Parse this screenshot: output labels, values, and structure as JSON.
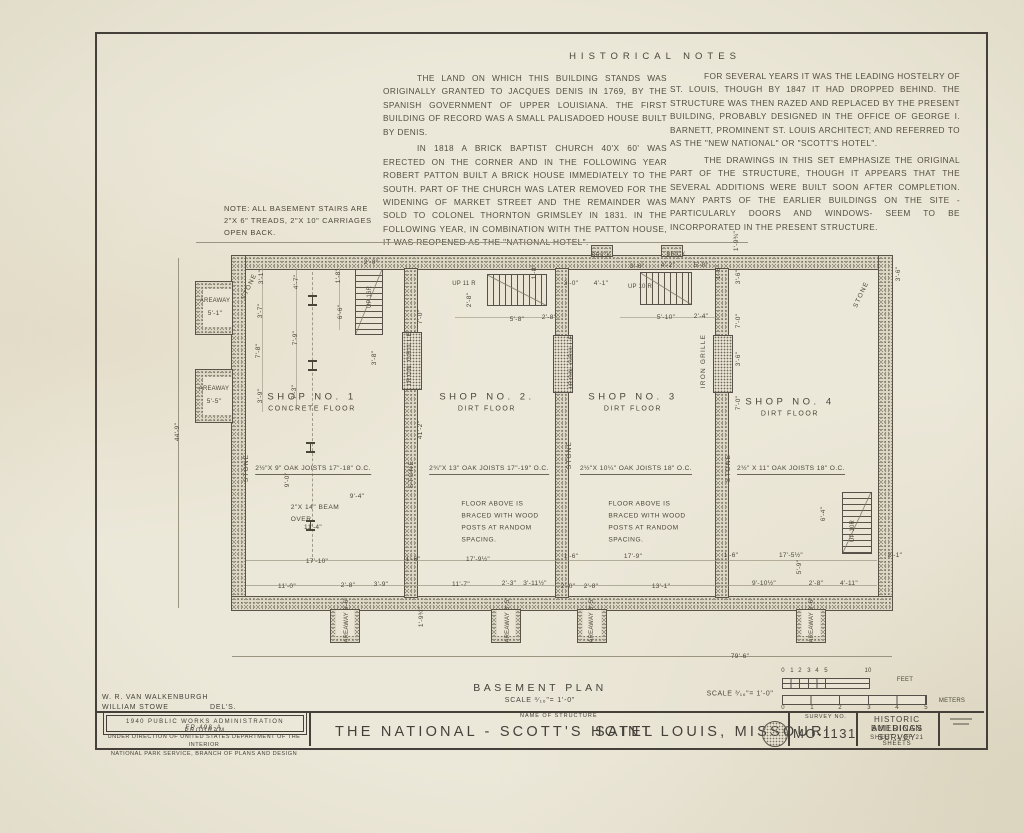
{
  "colors": {
    "paper": "#e9e4d4",
    "ink": "#46423a",
    "wall_fill": "#dcd7c4"
  },
  "notes": {
    "heading": "HISTORICAL NOTES",
    "col1": [
      "THE LAND ON WHICH THIS BUILDING STANDS WAS ORIGINALLY GRANTED TO JACQUES DENIS IN 1769, BY THE SPANISH GOVERNMENT OF UPPER LOUISIANA. THE FIRST BUILDING OF RECORD WAS A SMALL PALISADOED HOUSE BUILT BY DENIS.",
      "IN 1818 A BRICK BAPTIST CHURCH 40'X 60' WAS ERECTED ON THE CORNER AND IN THE FOLLOWING YEAR ROBERT PATTON BUILT A BRICK HOUSE IMMEDIATELY TO THE SOUTH. PART OF THE CHURCH WAS LATER REMOVED FOR THE WIDENING OF MARKET STREET AND THE REMAINDER WAS SOLD TO COLONEL THORNTON GRIMSLEY IN 1831. IN THE FOLLOWING YEAR, IN COMBINATION WITH THE PATTON HOUSE, IT WAS REOPENED AS THE \"NATIONAL HOTEL\"."
    ],
    "col2": [
      "FOR SEVERAL YEARS IT WAS THE LEADING HOSTELRY OF ST. LOUIS, THOUGH BY 1847 IT HAD DROPPED BEHIND. THE STRUCTURE WAS THEN RAZED AND REPLACED BY THE PRESENT BUILDING, PROBABLY DESIGNED IN THE OFFICE OF GEORGE I. BARNETT, PROMINENT ST. LOUIS ARCHITECT; AND REFERRED TO AS THE \"NEW NATIONAL\" OR \"SCOTT'S HOTEL\".",
      "THE DRAWINGS IN THIS SET EMPHASIZE THE ORIGINAL PART OF THE STRUCTURE, THOUGH IT APPEARS THAT THE SEVERAL ADDITIONS WERE BUILT SOON AFTER COMPLETION. MANY PARTS OF THE EARLIER BUILDINGS ON THE SITE - PARTICULARLY DOORS AND WINDOWS- SEEM TO BE INCORPORATED IN THE PRESENT STRUCTURE."
    ]
  },
  "stair_note": [
    "NOTE: ALL BASEMENT STAIRS ARE",
    "2\"X 6\" TREADS, 2\"X 10\" CARRIAGES",
    "OPEN BACK."
  ],
  "plan": {
    "shops": [
      {
        "name": "SHOP NO. 1",
        "floor": "CONCRETE FLOOR",
        "x": 312,
        "y": 402
      },
      {
        "name": "SHOP NO. 2.",
        "floor": "DIRT FLOOR",
        "x": 487,
        "y": 402
      },
      {
        "name": "SHOP NO. 3",
        "floor": "DIRT FLOOR",
        "x": 633,
        "y": 402
      },
      {
        "name": "SHOP NO. 4",
        "floor": "DIRT FLOOR",
        "x": 790,
        "y": 407
      }
    ],
    "joists": [
      {
        "t": "2½\"X 9\" OAK JOISTS 17\"-18\" O.C.",
        "x": 313,
        "y": 470
      },
      {
        "t": "2¾\"X 13\" OAK JOISTS 17\"-19\" O.C.",
        "x": 489,
        "y": 470
      },
      {
        "t": "2½\"X 10¼\" OAK JOISTS 18\" O.C.",
        "x": 636,
        "y": 470
      },
      {
        "t": "2½\" X 11\" OAK JOISTS 18\" O.C.",
        "x": 791,
        "y": 470
      }
    ],
    "floor_note": [
      "FLOOR ABOVE IS",
      "BRACED WITH WOOD",
      "POSTS AT RANDOM",
      "SPACING."
    ],
    "floor_note_pos": [
      {
        "x": 500,
        "y": 522
      },
      {
        "x": 647,
        "y": 522
      }
    ],
    "beam_note": [
      "2\"X 14\" BEAM",
      "OVER."
    ],
    "labels": [
      {
        "t": "STONE",
        "x": 250,
        "y": 287,
        "r": -65
      },
      {
        "t": "STONE",
        "x": 247,
        "y": 468,
        "r": -90
      },
      {
        "t": "STONE",
        "x": 412,
        "y": 474,
        "r": -90
      },
      {
        "t": "STONE",
        "x": 570,
        "y": 455,
        "r": -90
      },
      {
        "t": "STONE",
        "x": 729,
        "y": 468,
        "r": -90
      },
      {
        "t": "STONE",
        "x": 862,
        "y": 295,
        "r": -65
      },
      {
        "t": "IRON GRILLE",
        "x": 410,
        "y": 358,
        "r": -90
      },
      {
        "t": "IRON GRILLE",
        "x": 572,
        "y": 361,
        "r": -90
      },
      {
        "t": "IRON GRILLE",
        "x": 704,
        "y": 361,
        "r": -90
      },
      {
        "t": "BRICK",
        "x": 601,
        "y": 256,
        "cls": "tiny"
      },
      {
        "t": "BRICK",
        "x": 676,
        "y": 255,
        "cls": "tiny"
      },
      {
        "t": "AREAWAY",
        "x": 215,
        "y": 301,
        "cls": "tiny"
      },
      {
        "t": "AREAWAY",
        "x": 214,
        "y": 389,
        "cls": "tiny"
      },
      {
        "t": "AREAWAY 3'-6\"",
        "x": 347,
        "y": 620,
        "r": -90,
        "cls": "tiny"
      },
      {
        "t": "AREAWAY 3'-5\"",
        "x": 508,
        "y": 620,
        "r": -90,
        "cls": "tiny"
      },
      {
        "t": "AREAWAY 3'-5\"",
        "x": 592,
        "y": 620,
        "r": -90,
        "cls": "tiny"
      },
      {
        "t": "AREAWAY 3'-6\"",
        "x": 812,
        "y": 620,
        "r": -90,
        "cls": "tiny"
      },
      {
        "t": "UP 16R",
        "x": 370,
        "y": 297,
        "r": -90,
        "cls": "tiny"
      },
      {
        "t": "UP 11 R",
        "x": 464,
        "y": 284,
        "cls": "tiny"
      },
      {
        "t": "UP 10 R",
        "x": 640,
        "y": 287,
        "cls": "tiny"
      },
      {
        "t": "UP 10R",
        "x": 853,
        "y": 531,
        "r": -90,
        "cls": "tiny"
      },
      {
        "t": "0",
        "x": 783,
        "y": 671,
        "cls": "tiny"
      },
      {
        "t": "1",
        "x": 792,
        "y": 671,
        "cls": "tiny"
      },
      {
        "t": "2",
        "x": 800,
        "y": 671,
        "cls": "tiny"
      },
      {
        "t": "3",
        "x": 809,
        "y": 671,
        "cls": "tiny"
      },
      {
        "t": "4",
        "x": 817,
        "y": 671,
        "cls": "tiny"
      },
      {
        "t": "5",
        "x": 826,
        "y": 671,
        "cls": "tiny"
      },
      {
        "t": "10",
        "x": 868,
        "y": 671,
        "cls": "tiny"
      },
      {
        "t": "FEET",
        "x": 905,
        "y": 680,
        "cls": "tiny"
      },
      {
        "t": "0",
        "x": 783,
        "y": 708,
        "cls": "tiny"
      },
      {
        "t": "1",
        "x": 812,
        "y": 708,
        "cls": "tiny"
      },
      {
        "t": "2",
        "x": 840,
        "y": 708,
        "cls": "tiny"
      },
      {
        "t": "3",
        "x": 869,
        "y": 708,
        "cls": "tiny"
      },
      {
        "t": "4",
        "x": 897,
        "y": 708,
        "cls": "tiny"
      },
      {
        "t": "5",
        "x": 926,
        "y": 708,
        "cls": "tiny"
      },
      {
        "t": "METERS",
        "x": 952,
        "y": 701,
        "cls": "tiny"
      },
      {
        "t": "SCALE ³∕₁₆\"= 1'-0\"",
        "x": 740,
        "y": 694,
        "cls": "scale"
      }
    ],
    "dims": [
      {
        "t": "44'-9\"",
        "x": 178,
        "y": 432,
        "r": -90
      },
      {
        "t": "41'-2\"",
        "x": 421,
        "y": 430,
        "r": -90
      },
      {
        "t": "79'-6\"",
        "x": 740,
        "y": 657
      },
      {
        "t": "1'-9¾\"",
        "x": 737,
        "y": 241,
        "r": -90
      },
      {
        "t": "5'-1\"",
        "x": 215,
        "y": 314
      },
      {
        "t": "5'-5\"",
        "x": 214,
        "y": 402
      },
      {
        "t": "3'-1\"",
        "x": 262,
        "y": 277,
        "r": -90
      },
      {
        "t": "3'-7\"",
        "x": 261,
        "y": 311,
        "r": -90
      },
      {
        "t": "7'-8\"",
        "x": 259,
        "y": 351,
        "r": -90
      },
      {
        "t": "3'-9\"",
        "x": 261,
        "y": 396,
        "r": -90
      },
      {
        "t": "4'-7\"",
        "x": 297,
        "y": 282,
        "r": -90
      },
      {
        "t": "7'-9\"",
        "x": 296,
        "y": 338,
        "r": -90
      },
      {
        "t": "7'-3\"",
        "x": 295,
        "y": 392,
        "r": -90
      },
      {
        "t": "1'-8\"",
        "x": 339,
        "y": 276,
        "r": -90
      },
      {
        "t": "6'-6\"",
        "x": 341,
        "y": 312,
        "r": -90
      },
      {
        "t": "3'-8\"",
        "x": 375,
        "y": 358,
        "r": -90
      },
      {
        "t": "7'-0\"",
        "x": 421,
        "y": 317,
        "r": -90
      },
      {
        "t": "2'-0\"",
        "x": 371,
        "y": 263
      },
      {
        "t": "2'-8\"",
        "x": 470,
        "y": 300,
        "r": -90
      },
      {
        "t": "1'-8\"",
        "x": 535,
        "y": 272,
        "r": -90
      },
      {
        "t": "5'-8\"",
        "x": 517,
        "y": 320
      },
      {
        "t": "2'-8\"",
        "x": 549,
        "y": 318
      },
      {
        "t": "3'-0\"",
        "x": 571,
        "y": 284
      },
      {
        "t": "4'-1\"",
        "x": 601,
        "y": 284
      },
      {
        "t": "3'-6\"",
        "x": 637,
        "y": 267
      },
      {
        "t": "4'-2\"",
        "x": 668,
        "y": 266
      },
      {
        "t": "5'-0\"",
        "x": 701,
        "y": 266
      },
      {
        "t": "5'-10\"",
        "x": 666,
        "y": 318
      },
      {
        "t": "2'-4\"",
        "x": 701,
        "y": 317
      },
      {
        "t": "1'-8\"",
        "x": 719,
        "y": 272,
        "r": -90
      },
      {
        "t": "3'-6\"",
        "x": 739,
        "y": 277,
        "r": -90
      },
      {
        "t": "7'-0\"",
        "x": 739,
        "y": 321,
        "r": -90
      },
      {
        "t": "3'-6\"",
        "x": 739,
        "y": 359,
        "r": -90
      },
      {
        "t": "7'-0\"",
        "x": 739,
        "y": 403,
        "r": -90
      },
      {
        "t": "3'-6\"",
        "x": 899,
        "y": 274,
        "r": -90
      },
      {
        "t": "9'-0\"",
        "x": 288,
        "y": 480,
        "r": -90
      },
      {
        "t": "9'-4\"",
        "x": 357,
        "y": 497
      },
      {
        "t": "11'-4\"",
        "x": 313,
        "y": 528
      },
      {
        "t": "6'-4\"",
        "x": 824,
        "y": 514,
        "r": -90
      },
      {
        "t": "5'-9\"",
        "x": 800,
        "y": 567,
        "r": -90
      },
      {
        "t": "17'-10\"",
        "x": 317,
        "y": 562
      },
      {
        "t": "1'-6\"",
        "x": 413,
        "y": 560
      },
      {
        "t": "17'-9½\"",
        "x": 478,
        "y": 560
      },
      {
        "t": "1'-6\"",
        "x": 571,
        "y": 557
      },
      {
        "t": "17'-9\"",
        "x": 633,
        "y": 557
      },
      {
        "t": "1'-6\"",
        "x": 731,
        "y": 556
      },
      {
        "t": "17'-5½\"",
        "x": 791,
        "y": 556
      },
      {
        "t": "2'-1\"",
        "x": 895,
        "y": 556
      },
      {
        "t": "11'-0\"",
        "x": 287,
        "y": 587
      },
      {
        "t": "2'-8\"",
        "x": 348,
        "y": 586
      },
      {
        "t": "3'-9\"",
        "x": 381,
        "y": 585
      },
      {
        "t": "11'-7\"",
        "x": 461,
        "y": 585
      },
      {
        "t": "2'-3\"",
        "x": 509,
        "y": 584
      },
      {
        "t": "3'-11½\"",
        "x": 535,
        "y": 584
      },
      {
        "t": "2'-0\"",
        "x": 568,
        "y": 587
      },
      {
        "t": "2'-8\"",
        "x": 591,
        "y": 587
      },
      {
        "t": "13'-1\"",
        "x": 661,
        "y": 587
      },
      {
        "t": "9'-10½\"",
        "x": 764,
        "y": 584
      },
      {
        "t": "2'-8\"",
        "x": 816,
        "y": 584
      },
      {
        "t": "4'-11\"",
        "x": 849,
        "y": 584
      },
      {
        "t": "1'-9¾\"",
        "x": 422,
        "y": 617,
        "r": -90
      }
    ]
  },
  "plan_title": {
    "title": "BASEMENT PLAN",
    "scale": "SCALE ³∕₁₆\"= 1'-0\""
  },
  "titleblock": {
    "del1": "W. R. VAN WALKENBURGH",
    "del2": "WILLIAM STOWE",
    "del2b": "DEL'S.",
    "pwa1": "1940 PUBLIC WORKS ADMINISTRATION PROGRAM",
    "pwa2": "FP 498-A",
    "interior1": "UNDER DIRECTION OF UNITED STATES DEPARTMENT OF THE INTERIOR",
    "interior2": "NATIONAL PARK SERVICE, BRANCH OF PLANS AND DESIGN",
    "name_label": "NAME OF STRUCTURE",
    "structure": "THE NATIONAL - SCOTT'S HOTEL",
    "location": "SAINT LOUIS, MISSOURI",
    "survey_label": "SURVEY NO.",
    "survey_no": "MO-1131",
    "habs1": "HISTORIC AMERICAN",
    "habs2": "BUILDINGS SURVEY",
    "habs3": "SHEET 1 OF 21 SHEETS"
  }
}
